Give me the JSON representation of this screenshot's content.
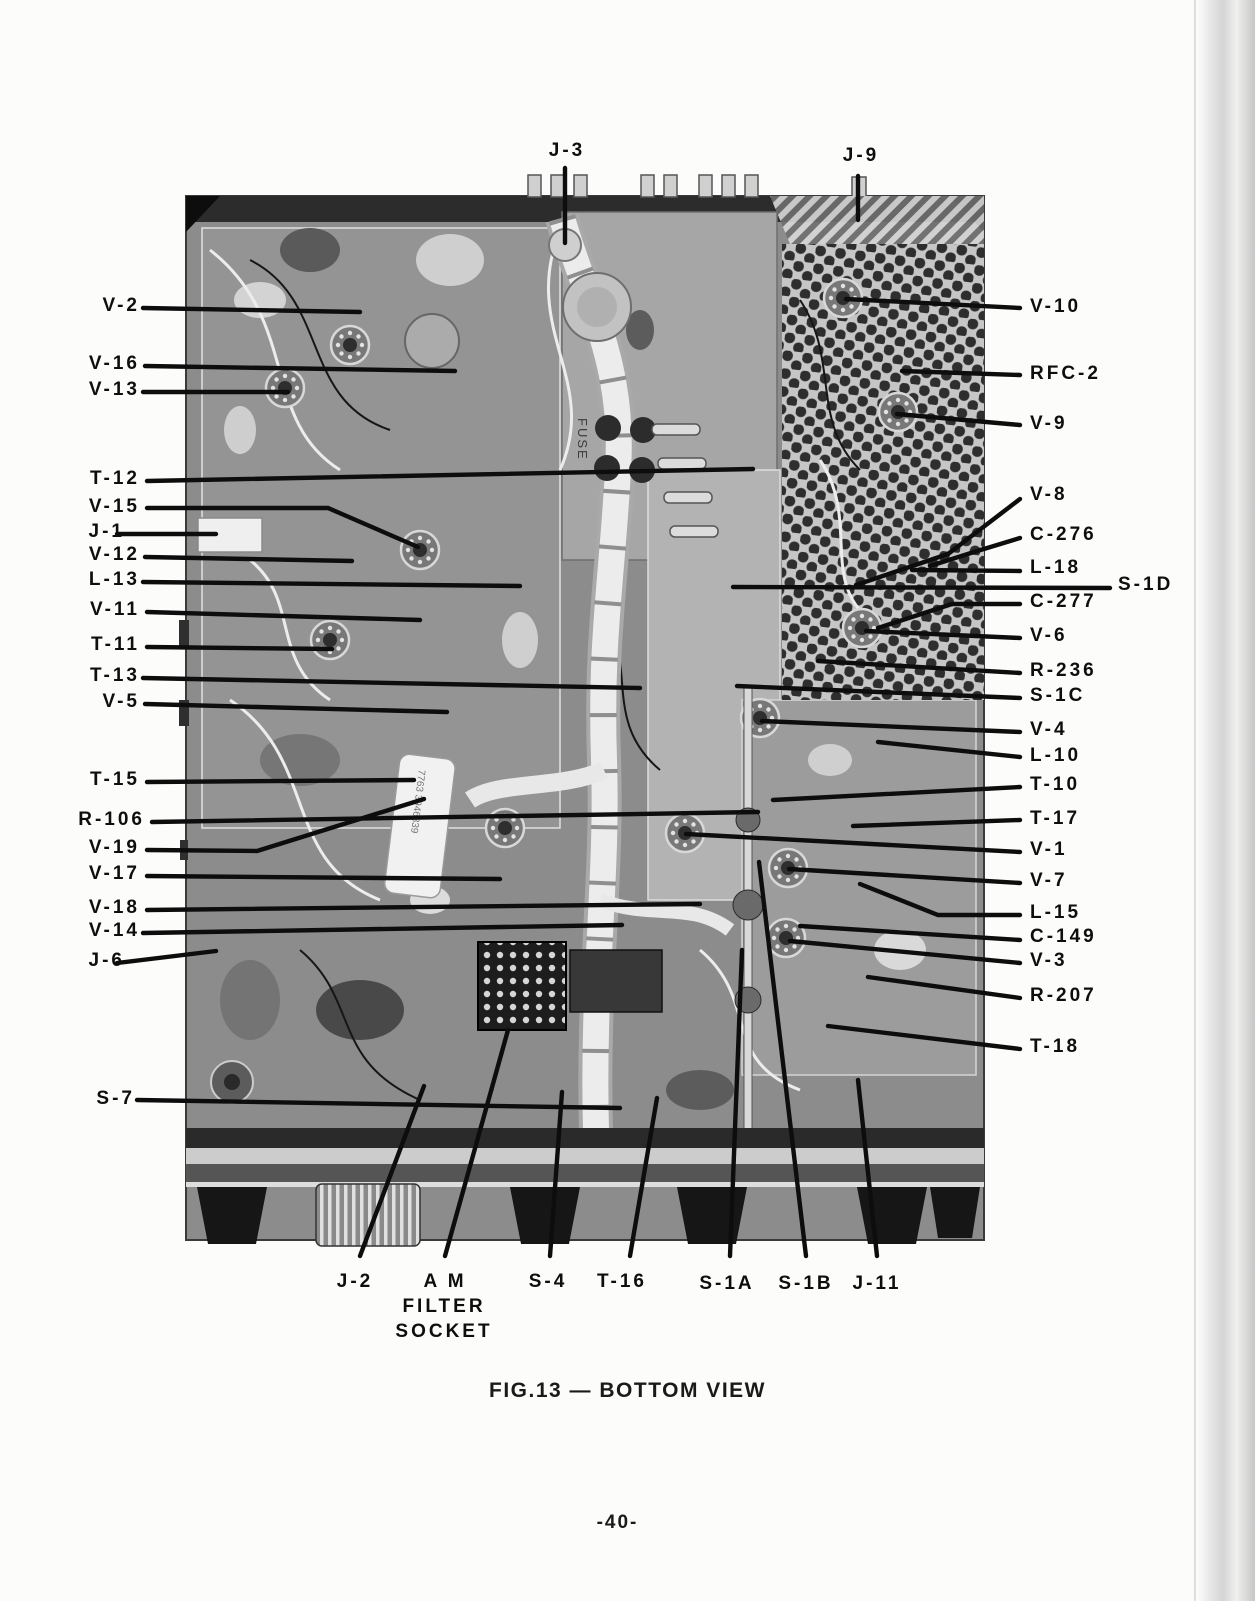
{
  "page": {
    "number": "-40-"
  },
  "figure": {
    "caption": "FIG.13 — BOTTOM VIEW",
    "photo_texts": {
      "fuse": "FUSE",
      "capacitor_code": "7763 3946839"
    }
  },
  "labels": {
    "j3": "J-3",
    "j9": "J-9",
    "v2": "V-2",
    "v16": "V-16",
    "v13": "V-13",
    "t12": "T-12",
    "v15": "V-15",
    "j1": "J-1",
    "v12": "V-12",
    "l13": "L-13",
    "v11": "V-11",
    "t11": "T-11",
    "t13": "T-13",
    "v5": "V-5",
    "t15": "T-15",
    "r106": "R-106",
    "v19": "V-19",
    "v17": "V-17",
    "v18": "V-18",
    "v14": "V-14",
    "j6": "J-6",
    "s7": "S-7",
    "v10": "V-10",
    "rfc2": "RFC-2",
    "v9": "V-9",
    "v8": "V-8",
    "c276": "C-276",
    "l18": "L-18",
    "s1d": "S-1D",
    "c277": "C-277",
    "v6": "V-6",
    "r236": "R-236",
    "s1c": "S-1C",
    "v4": "V-4",
    "l10": "L-10",
    "t10": "T-10",
    "t17": "T-17",
    "v1": "V-1",
    "v7": "V-7",
    "l15": "L-15",
    "c149": "C-149",
    "v3": "V-3",
    "r207": "R-207",
    "t18": "T-18",
    "j2": "J-2",
    "am1": "A M",
    "am2": "FILTER",
    "am3": "SOCKET",
    "s4": "S-4",
    "t16": "T-16",
    "s1a": "S-1A",
    "s1b": "S-1B",
    "j11": "J-11"
  }
}
